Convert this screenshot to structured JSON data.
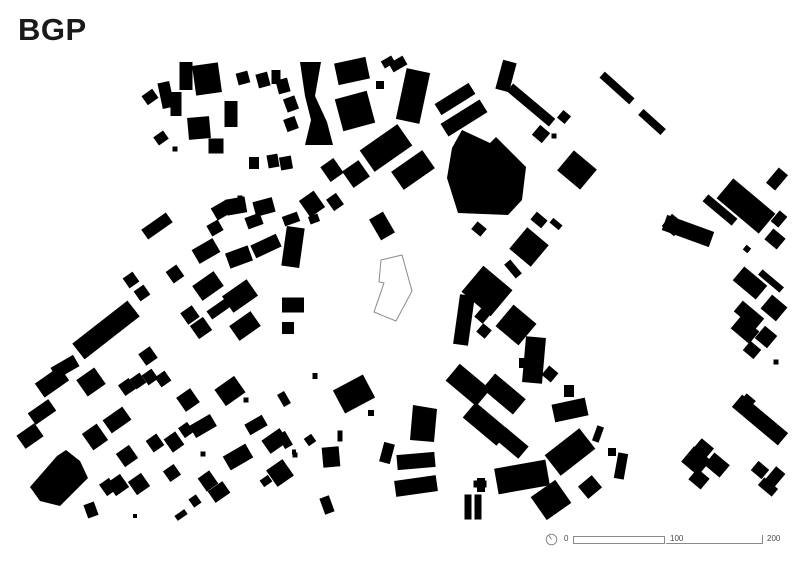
{
  "title": "BGP",
  "map": {
    "background": "#ffffff",
    "building_color": "#000000",
    "site_outline_color": "#8a8a8a",
    "site_fill": "#ffffff",
    "site_polygon": [
      [
        381,
        260
      ],
      [
        402,
        255
      ],
      [
        412,
        291
      ],
      [
        396,
        321
      ],
      [
        374,
        312
      ],
      [
        384,
        283
      ],
      [
        379,
        282
      ]
    ],
    "buildings": [
      [
        186,
        76,
        13,
        28,
        0
      ],
      [
        207,
        79,
        26,
        30,
        -8
      ],
      [
        176,
        104,
        11,
        24,
        0
      ],
      [
        199,
        128,
        22,
        22,
        -5
      ],
      [
        231,
        114,
        13,
        26,
        0
      ],
      [
        216,
        146,
        15,
        15,
        0
      ],
      [
        166,
        95,
        12,
        26,
        -12
      ],
      [
        150,
        97,
        13,
        11,
        -35
      ],
      [
        161,
        138,
        12,
        10,
        -35
      ],
      [
        243,
        78,
        12,
        12,
        -15
      ],
      [
        263,
        80,
        12,
        14,
        -15
      ],
      [
        283,
        86,
        12,
        14,
        -15
      ],
      [
        254,
        163,
        10,
        12,
        0
      ],
      [
        273,
        161,
        11,
        13,
        -10
      ],
      [
        286,
        163,
        12,
        13,
        -10
      ],
      [
        175,
        149,
        5,
        5,
        0
      ],
      [
        236,
        206,
        20,
        16,
        -10
      ],
      [
        264,
        207,
        20,
        15,
        -15
      ],
      [
        312,
        204,
        18,
        20,
        -35
      ],
      [
        335,
        202,
        12,
        14,
        -35
      ],
      [
        314,
        219,
        10,
        8,
        -20
      ],
      [
        240,
        198,
        5,
        5,
        0
      ],
      [
        276,
        77,
        9,
        14,
        0
      ],
      [
        291,
        104,
        12,
        14,
        -20
      ],
      [
        291,
        124,
        12,
        13,
        -20
      ],
      [
        352,
        71,
        32,
        22,
        -12
      ],
      [
        388,
        62,
        12,
        8,
        -30
      ],
      [
        398,
        64,
        16,
        10,
        -30
      ],
      [
        380,
        85,
        8,
        8,
        0
      ],
      [
        355,
        111,
        33,
        33,
        -15
      ],
      [
        413,
        96,
        24,
        52,
        12
      ],
      [
        386,
        148,
        46,
        26,
        -35
      ],
      [
        413,
        170,
        38,
        22,
        -35
      ],
      [
        332,
        170,
        16,
        18,
        -35
      ],
      [
        356,
        174,
        20,
        20,
        -35
      ],
      [
        382,
        226,
        16,
        24,
        -30
      ],
      [
        455,
        99,
        40,
        13,
        -32
      ],
      [
        464,
        118,
        46,
        15,
        -32
      ],
      [
        506,
        76,
        14,
        30,
        15
      ],
      [
        531,
        105,
        55,
        10,
        40
      ],
      [
        541,
        134,
        13,
        13,
        40
      ],
      [
        554,
        136,
        5,
        5,
        0
      ],
      [
        564,
        117,
        10,
        10,
        40
      ],
      [
        577,
        170,
        30,
        26,
        40
      ],
      [
        617,
        88,
        40,
        8,
        42
      ],
      [
        652,
        122,
        30,
        8,
        42
      ],
      [
        539,
        220,
        14,
        10,
        40
      ],
      [
        556,
        224,
        12,
        6,
        40
      ],
      [
        688,
        231,
        50,
        16,
        20
      ],
      [
        720,
        210,
        38,
        9,
        40
      ],
      [
        746,
        206,
        55,
        26,
        40
      ],
      [
        777,
        179,
        12,
        20,
        40
      ],
      [
        779,
        219,
        10,
        14,
        40
      ],
      [
        775,
        239,
        16,
        14,
        40
      ],
      [
        747,
        249,
        6,
        6,
        40
      ],
      [
        750,
        283,
        30,
        18,
        40
      ],
      [
        771,
        281,
        28,
        7,
        40
      ],
      [
        749,
        315,
        28,
        14,
        40
      ],
      [
        774,
        308,
        20,
        18,
        40
      ],
      [
        745,
        330,
        24,
        16,
        40
      ],
      [
        766,
        337,
        16,
        16,
        40
      ],
      [
        752,
        350,
        14,
        12,
        40
      ],
      [
        776,
        362,
        5,
        5,
        0
      ],
      [
        760,
        420,
        60,
        16,
        40
      ],
      [
        748,
        401,
        12,
        10,
        40
      ],
      [
        696,
        461,
        22,
        20,
        40
      ],
      [
        704,
        448,
        16,
        12,
        40
      ],
      [
        717,
        465,
        20,
        16,
        40
      ],
      [
        699,
        479,
        16,
        14,
        40
      ],
      [
        760,
        470,
        14,
        12,
        40
      ],
      [
        775,
        477,
        12,
        18,
        40
      ],
      [
        768,
        487,
        18,
        10,
        40
      ],
      [
        529,
        247,
        28,
        28,
        40
      ],
      [
        513,
        269,
        18,
        8,
        50
      ],
      [
        487,
        291,
        38,
        34,
        40
      ],
      [
        464,
        320,
        15,
        50,
        8
      ],
      [
        482,
        316,
        11,
        11,
        40
      ],
      [
        484,
        331,
        11,
        11,
        40
      ],
      [
        516,
        325,
        30,
        28,
        40
      ],
      [
        534,
        360,
        20,
        46,
        5
      ],
      [
        524,
        363,
        10,
        10,
        0
      ],
      [
        479,
        229,
        12,
        10,
        40
      ],
      [
        468,
        385,
        40,
        22,
        40
      ],
      [
        504,
        394,
        40,
        20,
        40
      ],
      [
        486,
        424,
        44,
        20,
        40
      ],
      [
        512,
        443,
        30,
        16,
        40
      ],
      [
        550,
        374,
        12,
        12,
        40
      ],
      [
        673,
        225,
        16,
        16,
        40
      ],
      [
        522,
        477,
        52,
        26,
        -10
      ],
      [
        570,
        452,
        44,
        26,
        -38
      ],
      [
        551,
        500,
        30,
        28,
        -35
      ],
      [
        481,
        485,
        8,
        14,
        0
      ],
      [
        590,
        487,
        18,
        16,
        -40
      ],
      [
        570,
        410,
        34,
        18,
        -12
      ],
      [
        569,
        391,
        10,
        12,
        0
      ],
      [
        598,
        434,
        7,
        16,
        20
      ],
      [
        612,
        452,
        8,
        8,
        0
      ],
      [
        621,
        466,
        10,
        26,
        10
      ],
      [
        354,
        394,
        34,
        26,
        -28
      ],
      [
        371,
        413,
        6,
        6,
        0
      ],
      [
        315,
        376,
        5,
        6,
        0
      ],
      [
        284,
        399,
        8,
        14,
        -30
      ],
      [
        285,
        440,
        9,
        16,
        -30
      ],
      [
        294,
        452,
        4,
        5,
        0
      ],
      [
        331,
        457,
        17,
        20,
        -5
      ],
      [
        340,
        436,
        5,
        11,
        0
      ],
      [
        387,
        453,
        11,
        20,
        15
      ],
      [
        416,
        461,
        38,
        15,
        -5
      ],
      [
        416,
        486,
        42,
        16,
        -8
      ],
      [
        468,
        507,
        7,
        25,
        0
      ],
      [
        478,
        507,
        7,
        25,
        0
      ],
      [
        327,
        505,
        10,
        17,
        -20
      ],
      [
        480,
        484,
        13,
        7,
        0
      ],
      [
        310,
        440,
        9,
        9,
        -35
      ],
      [
        157,
        226,
        30,
        12,
        -35
      ],
      [
        222,
        210,
        18,
        14,
        -30
      ],
      [
        215,
        228,
        13,
        12,
        -30
      ],
      [
        254,
        221,
        16,
        12,
        -20
      ],
      [
        291,
        219,
        16,
        10,
        -20
      ],
      [
        206,
        251,
        24,
        16,
        -30
      ],
      [
        239,
        257,
        24,
        16,
        -20
      ],
      [
        266,
        246,
        28,
        14,
        -25
      ],
      [
        293,
        247,
        18,
        40,
        8
      ],
      [
        175,
        274,
        13,
        14,
        -35
      ],
      [
        208,
        286,
        26,
        18,
        -35
      ],
      [
        240,
        296,
        30,
        20,
        -35
      ],
      [
        220,
        308,
        26,
        10,
        -35
      ],
      [
        190,
        315,
        14,
        14,
        -35
      ],
      [
        201,
        328,
        16,
        16,
        -35
      ],
      [
        245,
        326,
        26,
        18,
        -35
      ],
      [
        293,
        305,
        22,
        15,
        0
      ],
      [
        288,
        328,
        12,
        12,
        0
      ],
      [
        131,
        280,
        12,
        12,
        -35
      ],
      [
        142,
        293,
        12,
        12,
        -35
      ],
      [
        106,
        330,
        70,
        20,
        -38
      ],
      [
        148,
        356,
        14,
        14,
        -35
      ],
      [
        65,
        367,
        26,
        13,
        -30
      ],
      [
        52,
        382,
        30,
        17,
        -35
      ],
      [
        91,
        382,
        22,
        20,
        -35
      ],
      [
        127,
        387,
        13,
        13,
        -35
      ],
      [
        138,
        381,
        12,
        12,
        -35
      ],
      [
        150,
        377,
        12,
        12,
        -35
      ],
      [
        163,
        379,
        12,
        12,
        -35
      ],
      [
        188,
        400,
        17,
        17,
        -35
      ],
      [
        230,
        391,
        24,
        20,
        -35
      ],
      [
        246,
        400,
        5,
        5,
        0
      ],
      [
        42,
        412,
        25,
        14,
        -35
      ],
      [
        30,
        436,
        22,
        16,
        -35
      ],
      [
        95,
        437,
        18,
        20,
        -35
      ],
      [
        117,
        420,
        24,
        16,
        -35
      ],
      [
        127,
        456,
        16,
        16,
        -35
      ],
      [
        155,
        443,
        13,
        14,
        -35
      ],
      [
        174,
        442,
        14,
        16,
        -35
      ],
      [
        186,
        430,
        11,
        12,
        -35
      ],
      [
        203,
        426,
        24,
        14,
        -30
      ],
      [
        256,
        425,
        20,
        12,
        -30
      ],
      [
        275,
        441,
        22,
        16,
        -35
      ],
      [
        238,
        457,
        26,
        16,
        -30
      ],
      [
        91,
        510,
        11,
        14,
        -20
      ],
      [
        108,
        487,
        12,
        14,
        -35
      ],
      [
        118,
        485,
        16,
        16,
        -35
      ],
      [
        139,
        484,
        16,
        16,
        -35
      ],
      [
        172,
        473,
        13,
        13,
        -35
      ],
      [
        181,
        515,
        12,
        6,
        -35
      ],
      [
        195,
        501,
        9,
        10,
        -35
      ],
      [
        208,
        481,
        14,
        16,
        -35
      ],
      [
        219,
        492,
        18,
        14,
        -35
      ],
      [
        280,
        473,
        20,
        20,
        -35
      ],
      [
        266,
        481,
        10,
        8,
        -35
      ],
      [
        203,
        454,
        5,
        5,
        0
      ],
      [
        295,
        455,
        5,
        5,
        0
      ],
      [
        135,
        516,
        4,
        4,
        0
      ]
    ],
    "building_polygons": [
      [
        [
          300,
          62
        ],
        [
          321,
          62
        ],
        [
          315,
          96
        ],
        [
          327,
          122
        ],
        [
          333,
          145
        ],
        [
          305,
          145
        ],
        [
          311,
          120
        ],
        [
          305,
          96
        ]
      ],
      [
        [
          462,
          130
        ],
        [
          490,
          143
        ],
        [
          496,
          137
        ],
        [
          526,
          167
        ],
        [
          522,
          200
        ],
        [
          508,
          215
        ],
        [
          458,
          213
        ],
        [
          447,
          178
        ],
        [
          452,
          148
        ]
      ],
      [
        [
          30,
          487
        ],
        [
          57,
          456
        ],
        [
          66,
          450
        ],
        [
          80,
          461
        ],
        [
          88,
          478
        ],
        [
          60,
          506
        ],
        [
          40,
          501
        ]
      ],
      [
        [
          413,
          405
        ],
        [
          437,
          409
        ],
        [
          434,
          442
        ],
        [
          410,
          440
        ]
      ]
    ]
  },
  "scale_bar": {
    "zero": "0",
    "hundred": "100",
    "two_hundred": "200",
    "color": "#8a8a8a",
    "north_icon": "compass-circle"
  }
}
